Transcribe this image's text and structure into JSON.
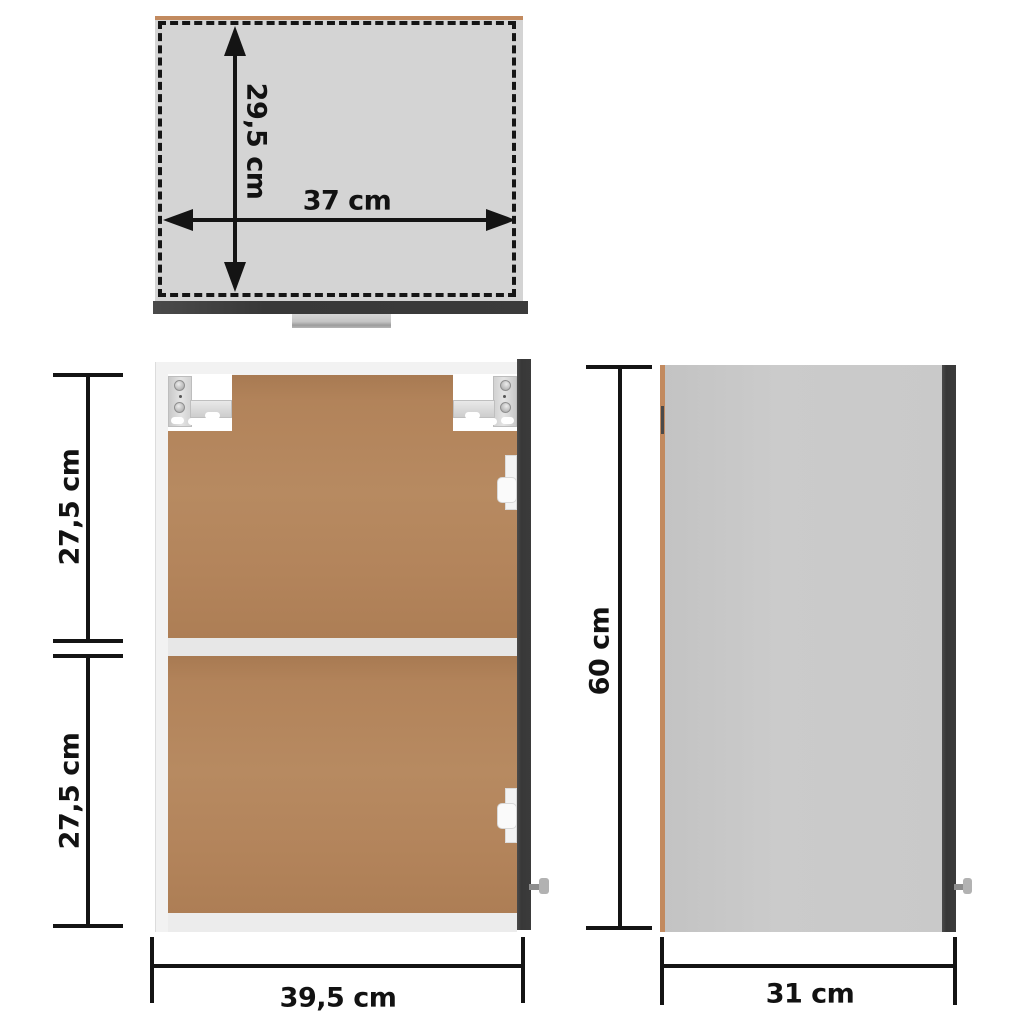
{
  "diagram_title": "wall-cabinet-dimension-diagram",
  "views": {
    "top": {
      "name": "top-view",
      "depth_label": "29,5 cm",
      "width_label": "37 cm"
    },
    "front": {
      "name": "front-view",
      "upper_label": "27,5 cm",
      "lower_label": "27,5 cm",
      "width_label": "39,5 cm"
    },
    "side": {
      "name": "side-view",
      "height_label": "60 cm",
      "depth_label": "31 cm"
    }
  },
  "colors": {
    "top_panel_gray": "#d4d4d4",
    "side_panel_gray": "#c9c9c9",
    "door_edge_dark": "#3b3b3b",
    "back_panel_brown": "#b4835c",
    "cabinet_frame_white": "#f2f2f2",
    "panel_edge_tan": "#c28a5f",
    "dimension_ink": "#141414",
    "handle_gray": "#b2b2b2"
  }
}
